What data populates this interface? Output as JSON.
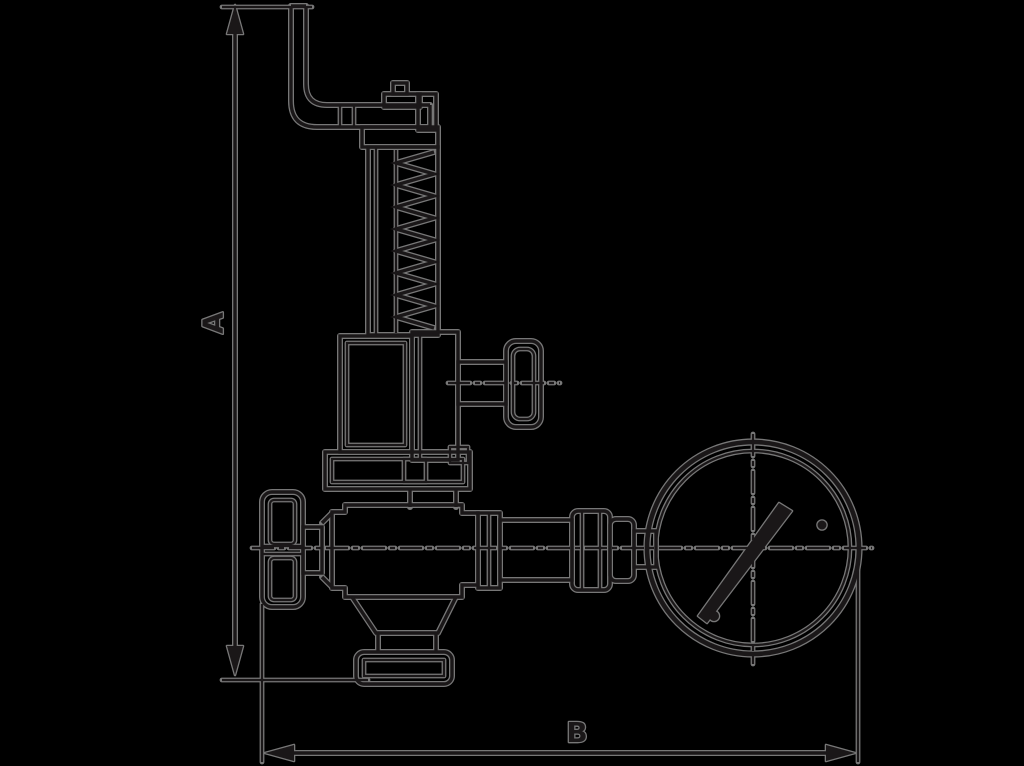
{
  "page": {
    "background_color": "#000000"
  },
  "diagram": {
    "type": "technical-line-drawing",
    "subject": "safety relief valve with test lever, handwheel and pressure gauge",
    "stroke_core_color": "#1a1718",
    "stroke_halo_color": "#7e7e7e",
    "dimensions": {
      "height_label": "A",
      "width_label": "B"
    }
  }
}
